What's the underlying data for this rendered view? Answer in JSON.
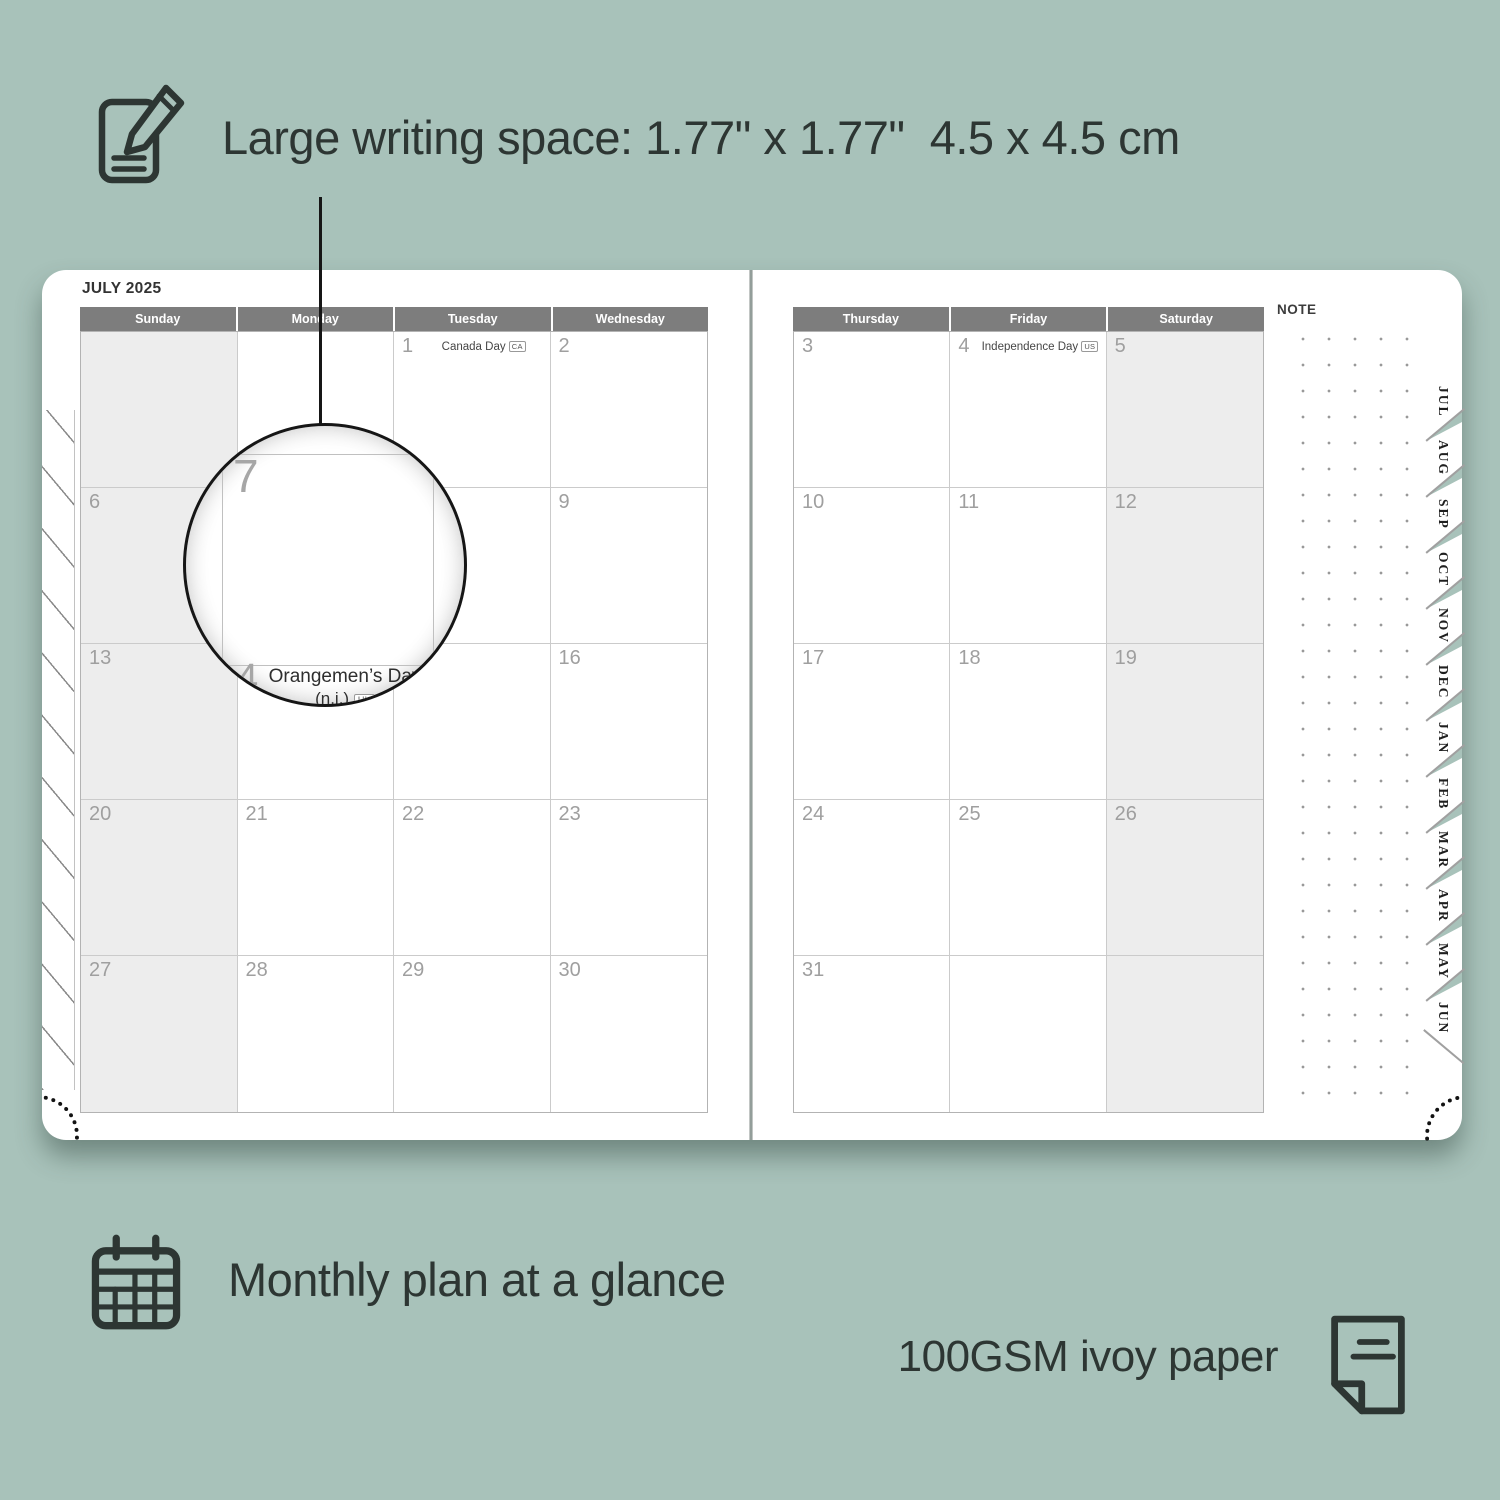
{
  "colors": {
    "background": "#a8c2ba",
    "header_bar": "#7d7d7d",
    "shaded_column": "#ededed",
    "annotation_text": "#2d3633"
  },
  "annotations": {
    "writing_space": {
      "label": "Large writing space: 1.77\" x 1.77\"  4.5 x 4.5 cm",
      "icon": "notepad-pencil-icon"
    },
    "monthly_plan": {
      "label": "Monthly plan at a glance",
      "icon": "calendar-grid-icon"
    },
    "paper": {
      "label": "100GSM ivoy paper",
      "icon": "paper-sheet-icon"
    }
  },
  "planner": {
    "month_title": "JULY 2025",
    "note_label": "NOTE",
    "pages": {
      "left": {
        "headers": [
          "Sunday",
          "Monday",
          "Tuesday",
          "Wednesday"
        ],
        "shaded_column": 0,
        "weeks": [
          [
            {
              "day": ""
            },
            {
              "day": ""
            },
            {
              "day": "1",
              "holiday": "Canada Day",
              "badge": "CA"
            },
            {
              "day": "2"
            }
          ],
          [
            {
              "day": "6"
            },
            {
              "day": "7"
            },
            {
              "day": "8"
            },
            {
              "day": "9"
            }
          ],
          [
            {
              "day": "13"
            },
            {
              "day": "14",
              "holiday": "Orangemen’s Day (n.i.)",
              "badge": "UK"
            },
            {
              "day": "15"
            },
            {
              "day": "16"
            }
          ],
          [
            {
              "day": "20"
            },
            {
              "day": "21"
            },
            {
              "day": "22"
            },
            {
              "day": "23"
            }
          ],
          [
            {
              "day": "27"
            },
            {
              "day": "28"
            },
            {
              "day": "29"
            },
            {
              "day": "30"
            }
          ]
        ]
      },
      "right": {
        "headers": [
          "Thursday",
          "Friday",
          "Saturday"
        ],
        "shaded_column": 2,
        "weeks": [
          [
            {
              "day": "3"
            },
            {
              "day": "4",
              "holiday": "Independence Day",
              "badge": "US"
            },
            {
              "day": "5"
            }
          ],
          [
            {
              "day": "10"
            },
            {
              "day": "11"
            },
            {
              "day": "12"
            }
          ],
          [
            {
              "day": "17"
            },
            {
              "day": "18"
            },
            {
              "day": "19"
            }
          ],
          [
            {
              "day": "24"
            },
            {
              "day": "25"
            },
            {
              "day": "26"
            }
          ],
          [
            {
              "day": "31"
            },
            {
              "day": ""
            },
            {
              "day": ""
            }
          ]
        ]
      }
    },
    "month_tabs": [
      "JUL",
      "AUG",
      "SEP",
      "OCT",
      "NOV",
      "DEC",
      "JAN",
      "FEB",
      "MAR",
      "APR",
      "MAY",
      "JUN"
    ],
    "magnifier": {
      "day": "7",
      "partial_day": "4",
      "holiday_line1": "Orangemen’s Day",
      "holiday_line2": "(n.i.)",
      "holiday_badge": "UK"
    }
  }
}
